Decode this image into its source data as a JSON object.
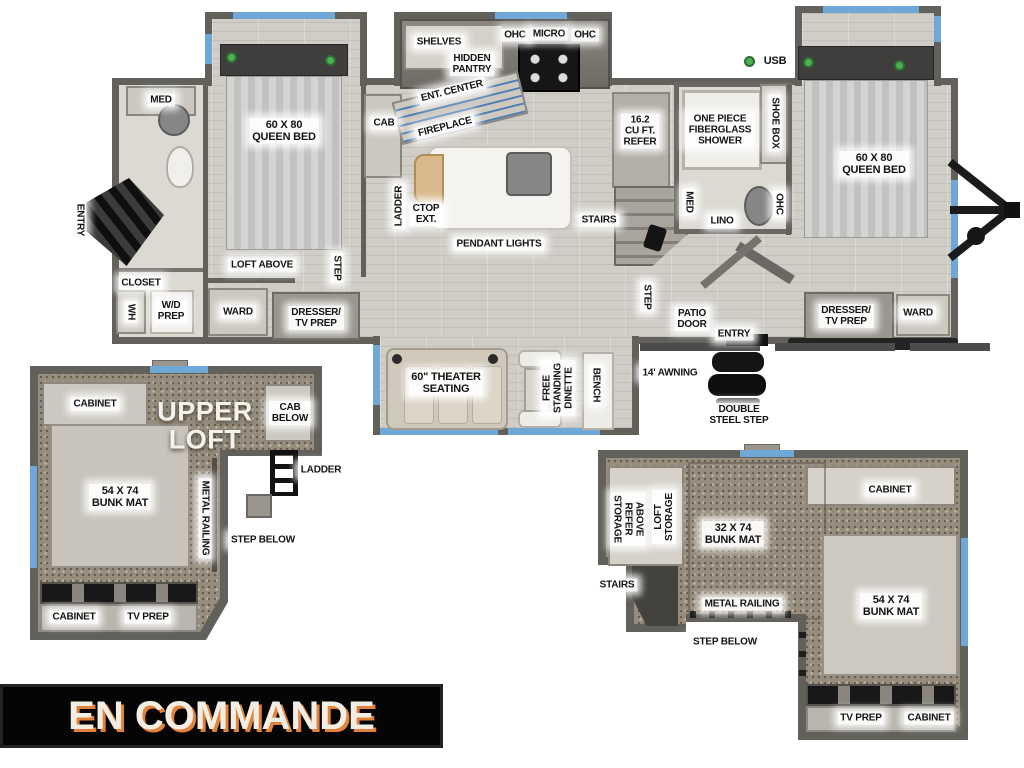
{
  "banner": {
    "label": "EN COMMANDE"
  },
  "colors": {
    "banner_bg": "#050505",
    "banner_text": "#f3eee4",
    "banner_shadow": "#e2813c",
    "wall": "#61605b",
    "wood_floor": "#d0cdc7",
    "loft_carpet": "#978d7e",
    "window_accent": "#6fa8d6",
    "led_green": "#4caf50",
    "island": "#f4f3f0"
  },
  "main": {
    "bath_left": {
      "med": "MED",
      "entry": "ENTRY",
      "closet": "CLOSET",
      "wh": "WH",
      "wd_prep": "W/D\nPREP"
    },
    "bedroom_left": {
      "queen_bed": "60 X 80\nQUEEN BED",
      "loft_above": "LOFT ABOVE",
      "step": "STEP",
      "ward": "WARD",
      "dresser_tv_prep": "DRESSER/\nTV PREP",
      "cab": "CAB"
    },
    "kitchen": {
      "shelves": "SHELVES",
      "hidden_pantry": "HIDDEN\nPANTRY",
      "ent_center": "ENT. CENTER",
      "fireplace": "FIREPLACE",
      "ohc_left": "OHC",
      "micro": "MICRO",
      "ohc_right": "OHC",
      "ladder": "LADDER",
      "ctop_ext": "CTOP\nEXT.",
      "pendant_lights": "PENDANT LIGHTS",
      "refer": "16.2\nCU FT.\nREFER",
      "stairs": "STAIRS"
    },
    "bath_mid": {
      "shower": "ONE PIECE\nFIBERGLASS\nSHOWER",
      "shoe_box": "SHOE BOX",
      "usb": "USB",
      "med": "MED",
      "lino": "LINO",
      "ohc": "OHC"
    },
    "bedroom_right": {
      "queen_bed": "60 X 80\nQUEEN BED",
      "dresser_tv_prep": "DRESSER/\nTV PREP",
      "ward": "WARD",
      "step": "STEP",
      "patio_door": "PATIO\nDOOR",
      "entry": "ENTRY"
    },
    "living_slide": {
      "theater_seating": "60\" THEATER\nSEATING",
      "dinette": "FREE\nSTANDING\nDINETTE",
      "bench": "BENCH"
    },
    "exterior": {
      "awning": "14' AWNING",
      "double_steel_step": "DOUBLE\nSTEEL STEP"
    }
  },
  "loft_left": {
    "cabinet_top": "CABINET",
    "upper_loft": "UPPER\nLOFT",
    "cab_below": "CAB\nBELOW",
    "ladder": "LADDER",
    "bunk_mat": "54 X 74\nBUNK MAT",
    "metal_railing": "METAL RAILING",
    "step_below": "STEP BELOW",
    "cabinet_bottom": "CABINET",
    "tv_prep": "TV PREP"
  },
  "loft_right": {
    "above_refer_storage": "ABOVE\nREFER\nSTORAGE",
    "loft_storage": "LOFT\nSTORAGE",
    "cabinet_top": "CABINET",
    "bunk_mat_32": "32 X 74\nBUNK MAT",
    "stairs": "STAIRS",
    "metal_railing": "METAL RAILING",
    "step_below": "STEP BELOW",
    "bunk_mat_54": "54 X 74\nBUNK MAT",
    "tv_prep": "TV PREP",
    "cabinet_bottom": "CABINET"
  },
  "icons": {
    "led_indicator": "green-dot",
    "hitch": "trailer-hitch",
    "window": "blue-window-strip"
  }
}
